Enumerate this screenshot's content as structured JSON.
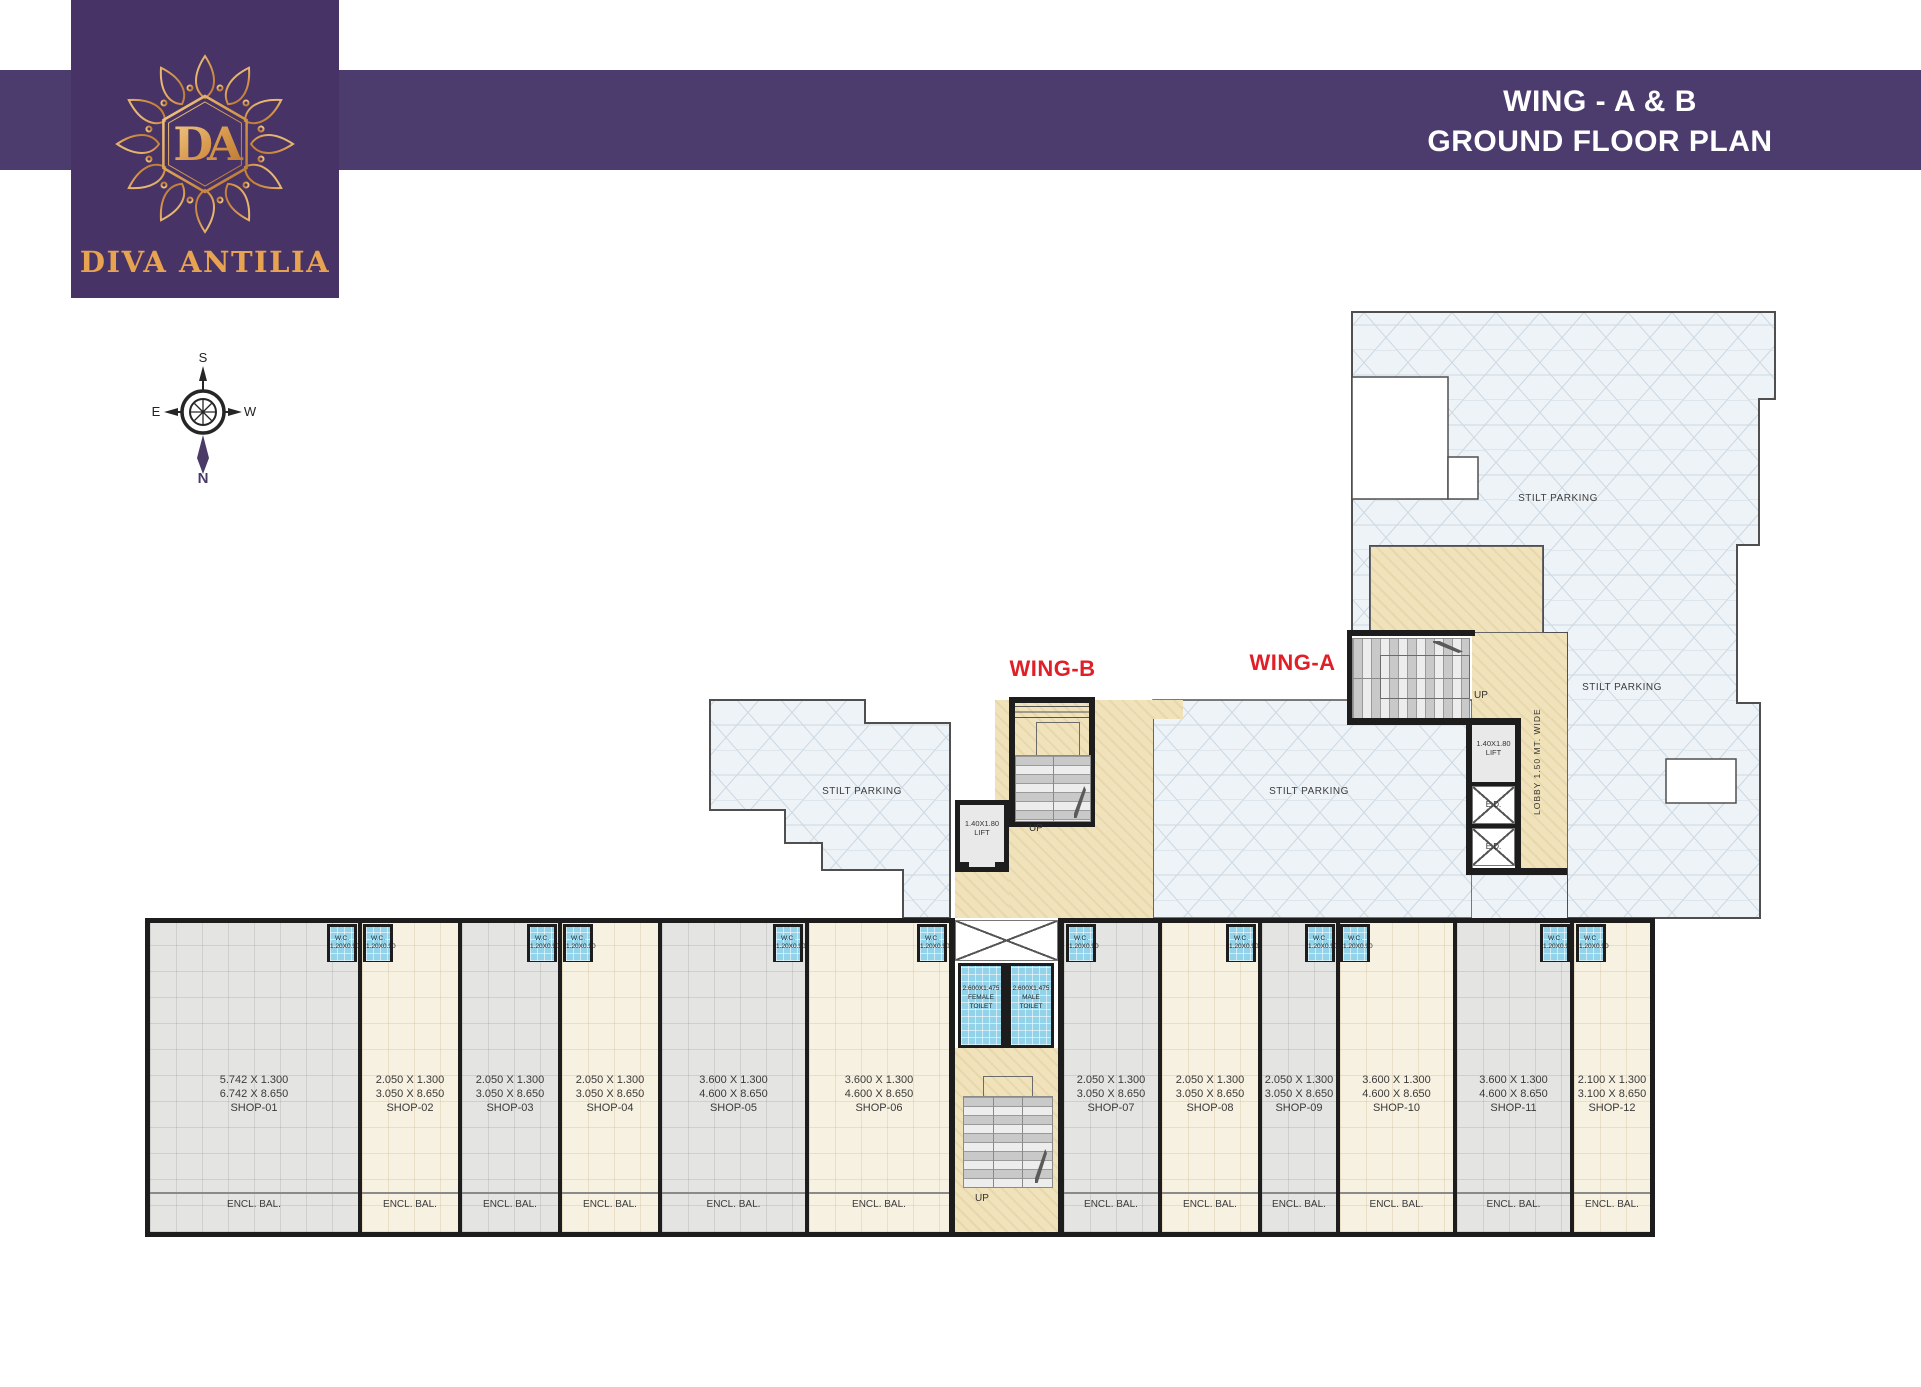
{
  "brand": {
    "name": "DIVA ANTILIA",
    "monogram": "DA"
  },
  "header": {
    "title_line1": "WING - A & B",
    "title_line2": "GROUND FLOOR PLAN"
  },
  "compass": {
    "n": "N",
    "s": "S",
    "e": "E",
    "w": "W"
  },
  "plan": {
    "wing_a": "WING-A",
    "wing_b": "WING-B",
    "stilt_parking": "STILT PARKING",
    "up": "UP",
    "lift_dim": "1.40X1.80",
    "lift": "LIFT",
    "ed": "E.D.",
    "lobby": "LOBBY 1.50 MT. WIDE",
    "wc": "W.C.",
    "wc_dim": "1.20X0.90",
    "female_toilet": {
      "dim": "2.600X1.475",
      "l1": "FEMALE",
      "l2": "TOILET"
    },
    "male_toilet": {
      "dim": "2.600X1.475",
      "l1": "MALE",
      "l2": "TOILET"
    },
    "encl_bal": "ENCL. BAL."
  },
  "shops": [
    {
      "dim1": "5.742 X 1.300",
      "dim2": "6.742 X 8.650",
      "name": "SHOP-01"
    },
    {
      "dim1": "2.050 X 1.300",
      "dim2": "3.050 X 8.650",
      "name": "SHOP-02"
    },
    {
      "dim1": "2.050 X 1.300",
      "dim2": "3.050 X 8.650",
      "name": "SHOP-03"
    },
    {
      "dim1": "2.050 X 1.300",
      "dim2": "3.050 X 8.650",
      "name": "SHOP-04"
    },
    {
      "dim1": "3.600 X 1.300",
      "dim2": "4.600 X 8.650",
      "name": "SHOP-05"
    },
    {
      "dim1": "3.600 X 1.300",
      "dim2": "4.600 X 8.650",
      "name": "SHOP-06"
    },
    {
      "dim1": "2.050 X 1.300",
      "dim2": "3.050 X 8.650",
      "name": "SHOP-07"
    },
    {
      "dim1": "2.050 X 1.300",
      "dim2": "3.050 X 8.650",
      "name": "SHOP-08"
    },
    {
      "dim1": "2.050 X 1.300",
      "dim2": "3.050 X 8.650",
      "name": "SHOP-09"
    },
    {
      "dim1": "3.600 X 1.300",
      "dim2": "4.600 X 8.650",
      "name": "SHOP-10"
    },
    {
      "dim1": "3.600 X 1.300",
      "dim2": "4.600 X 8.650",
      "name": "SHOP-11"
    },
    {
      "dim1": "2.100 X 1.300",
      "dim2": "3.100 X 8.650",
      "name": "SHOP-12"
    }
  ],
  "colors": {
    "brand_purple": "#4a3a68",
    "brand_gold": "#e2a04d",
    "accent_red": "#e11f26",
    "lobby_beige": "#f0e2ba",
    "parking_tint": "#eef3f8"
  }
}
